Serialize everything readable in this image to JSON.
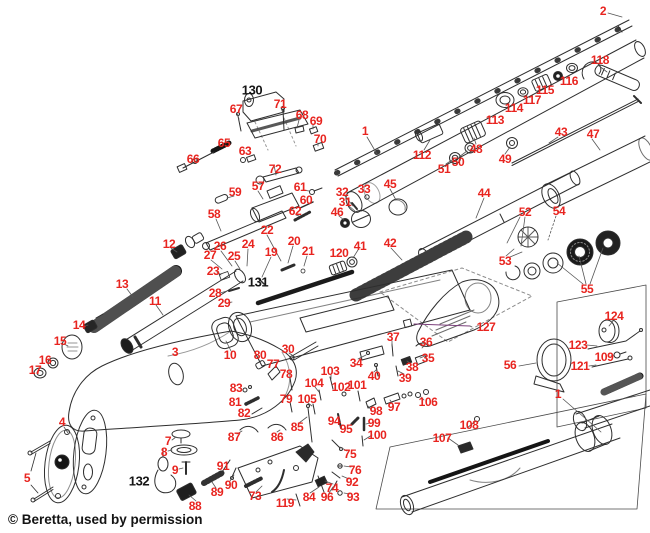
{
  "diagram": {
    "type": "exploded-parts-diagram",
    "subject": "Beretta shotgun exploded parts schematic",
    "copyright": "© Beretta, used by permission",
    "label_color": "#e8241f",
    "black_label_color": "#151515",
    "labels": [
      {
        "n": "1",
        "x": 365,
        "y": 131
      },
      {
        "n": "1",
        "x": 558,
        "y": 394
      },
      {
        "n": "2",
        "x": 603,
        "y": 11
      },
      {
        "n": "3",
        "x": 175,
        "y": 352
      },
      {
        "n": "4",
        "x": 62,
        "y": 422
      },
      {
        "n": "5",
        "x": 27,
        "y": 478
      },
      {
        "n": "7",
        "x": 168,
        "y": 441
      },
      {
        "n": "8",
        "x": 164,
        "y": 452
      },
      {
        "n": "9",
        "x": 175,
        "y": 470
      },
      {
        "n": "10",
        "x": 230,
        "y": 355
      },
      {
        "n": "11",
        "x": 155,
        "y": 301
      },
      {
        "n": "12",
        "x": 169,
        "y": 244
      },
      {
        "n": "13",
        "x": 122,
        "y": 284
      },
      {
        "n": "14",
        "x": 79,
        "y": 325
      },
      {
        "n": "15",
        "x": 60,
        "y": 341
      },
      {
        "n": "16",
        "x": 45,
        "y": 360
      },
      {
        "n": "17",
        "x": 35,
        "y": 370
      },
      {
        "n": "19",
        "x": 271,
        "y": 252
      },
      {
        "n": "20",
        "x": 294,
        "y": 241
      },
      {
        "n": "21",
        "x": 308,
        "y": 251
      },
      {
        "n": "22",
        "x": 267,
        "y": 230
      },
      {
        "n": "23",
        "x": 213,
        "y": 271
      },
      {
        "n": "24",
        "x": 248,
        "y": 244
      },
      {
        "n": "25",
        "x": 234,
        "y": 256
      },
      {
        "n": "26",
        "x": 220,
        "y": 246
      },
      {
        "n": "27",
        "x": 210,
        "y": 255
      },
      {
        "n": "28",
        "x": 215,
        "y": 293
      },
      {
        "n": "29",
        "x": 224,
        "y": 303
      },
      {
        "n": "30",
        "x": 288,
        "y": 349
      },
      {
        "n": "31",
        "x": 345,
        "y": 202
      },
      {
        "n": "32",
        "x": 342,
        "y": 192
      },
      {
        "n": "33",
        "x": 364,
        "y": 189
      },
      {
        "n": "34",
        "x": 356,
        "y": 363
      },
      {
        "n": "35",
        "x": 428,
        "y": 358
      },
      {
        "n": "36",
        "x": 426,
        "y": 342
      },
      {
        "n": "37",
        "x": 393,
        "y": 337
      },
      {
        "n": "38",
        "x": 412,
        "y": 367
      },
      {
        "n": "39",
        "x": 405,
        "y": 378
      },
      {
        "n": "40",
        "x": 374,
        "y": 376
      },
      {
        "n": "41",
        "x": 360,
        "y": 246
      },
      {
        "n": "42",
        "x": 390,
        "y": 243
      },
      {
        "n": "43",
        "x": 561,
        "y": 132
      },
      {
        "n": "44",
        "x": 484,
        "y": 193
      },
      {
        "n": "45",
        "x": 390,
        "y": 184
      },
      {
        "n": "46",
        "x": 337,
        "y": 212
      },
      {
        "n": "47",
        "x": 593,
        "y": 134
      },
      {
        "n": "48",
        "x": 476,
        "y": 149
      },
      {
        "n": "49",
        "x": 505,
        "y": 159
      },
      {
        "n": "50",
        "x": 458,
        "y": 162
      },
      {
        "n": "51",
        "x": 444,
        "y": 169
      },
      {
        "n": "52",
        "x": 525,
        "y": 212
      },
      {
        "n": "53",
        "x": 505,
        "y": 261
      },
      {
        "n": "54",
        "x": 559,
        "y": 211
      },
      {
        "n": "55",
        "x": 587,
        "y": 289
      },
      {
        "n": "56",
        "x": 510,
        "y": 365
      },
      {
        "n": "57",
        "x": 258,
        "y": 186
      },
      {
        "n": "58",
        "x": 214,
        "y": 214
      },
      {
        "n": "59",
        "x": 235,
        "y": 192
      },
      {
        "n": "60",
        "x": 306,
        "y": 200
      },
      {
        "n": "61",
        "x": 300,
        "y": 187
      },
      {
        "n": "62",
        "x": 295,
        "y": 211
      },
      {
        "n": "63",
        "x": 245,
        "y": 151
      },
      {
        "n": "65",
        "x": 224,
        "y": 143
      },
      {
        "n": "66",
        "x": 193,
        "y": 159
      },
      {
        "n": "67",
        "x": 236,
        "y": 109
      },
      {
        "n": "68",
        "x": 302,
        "y": 115
      },
      {
        "n": "69",
        "x": 316,
        "y": 121
      },
      {
        "n": "70",
        "x": 320,
        "y": 139
      },
      {
        "n": "71",
        "x": 280,
        "y": 104
      },
      {
        "n": "72",
        "x": 275,
        "y": 169
      },
      {
        "n": "73",
        "x": 255,
        "y": 496
      },
      {
        "n": "74",
        "x": 332,
        "y": 488
      },
      {
        "n": "75",
        "x": 350,
        "y": 454
      },
      {
        "n": "76",
        "x": 355,
        "y": 470
      },
      {
        "n": "77",
        "x": 273,
        "y": 364
      },
      {
        "n": "78",
        "x": 286,
        "y": 374
      },
      {
        "n": "79",
        "x": 286,
        "y": 399
      },
      {
        "n": "80",
        "x": 260,
        "y": 355
      },
      {
        "n": "81",
        "x": 235,
        "y": 402
      },
      {
        "n": "82",
        "x": 244,
        "y": 413
      },
      {
        "n": "83",
        "x": 236,
        "y": 388
      },
      {
        "n": "84",
        "x": 309,
        "y": 497
      },
      {
        "n": "85",
        "x": 297,
        "y": 427
      },
      {
        "n": "86",
        "x": 277,
        "y": 437
      },
      {
        "n": "87",
        "x": 234,
        "y": 437
      },
      {
        "n": "88",
        "x": 195,
        "y": 506
      },
      {
        "n": "89",
        "x": 217,
        "y": 492
      },
      {
        "n": "90",
        "x": 231,
        "y": 485
      },
      {
        "n": "91",
        "x": 223,
        "y": 466
      },
      {
        "n": "92",
        "x": 352,
        "y": 482
      },
      {
        "n": "93",
        "x": 353,
        "y": 497
      },
      {
        "n": "94",
        "x": 334,
        "y": 421
      },
      {
        "n": "95",
        "x": 346,
        "y": 429
      },
      {
        "n": "96",
        "x": 327,
        "y": 497
      },
      {
        "n": "97",
        "x": 394,
        "y": 407
      },
      {
        "n": "98",
        "x": 376,
        "y": 411
      },
      {
        "n": "99",
        "x": 374,
        "y": 423
      },
      {
        "n": "100",
        "x": 377,
        "y": 435
      },
      {
        "n": "101",
        "x": 357,
        "y": 385
      },
      {
        "n": "102",
        "x": 341,
        "y": 387
      },
      {
        "n": "103",
        "x": 330,
        "y": 371
      },
      {
        "n": "104",
        "x": 314,
        "y": 383
      },
      {
        "n": "105",
        "x": 307,
        "y": 399
      },
      {
        "n": "106",
        "x": 428,
        "y": 402
      },
      {
        "n": "107",
        "x": 442,
        "y": 438
      },
      {
        "n": "108",
        "x": 469,
        "y": 425
      },
      {
        "n": "109",
        "x": 604,
        "y": 357
      },
      {
        "n": "112",
        "x": 422,
        "y": 155
      },
      {
        "n": "113",
        "x": 495,
        "y": 120
      },
      {
        "n": "114",
        "x": 514,
        "y": 108
      },
      {
        "n": "115",
        "x": 545,
        "y": 90
      },
      {
        "n": "116",
        "x": 569,
        "y": 81
      },
      {
        "n": "117",
        "x": 532,
        "y": 100
      },
      {
        "n": "118",
        "x": 600,
        "y": 60
      },
      {
        "n": "119",
        "x": 285,
        "y": 503
      },
      {
        "n": "120",
        "x": 339,
        "y": 253
      },
      {
        "n": "121",
        "x": 580,
        "y": 366
      },
      {
        "n": "123",
        "x": 578,
        "y": 345
      },
      {
        "n": "124",
        "x": 614,
        "y": 316
      },
      {
        "n": "127",
        "x": 486,
        "y": 327
      },
      {
        "n": "130",
        "x": 252,
        "y": 90,
        "black": true
      },
      {
        "n": "131",
        "x": 258,
        "y": 282,
        "black": true
      },
      {
        "n": "132",
        "x": 139,
        "y": 481,
        "black": true
      }
    ]
  }
}
